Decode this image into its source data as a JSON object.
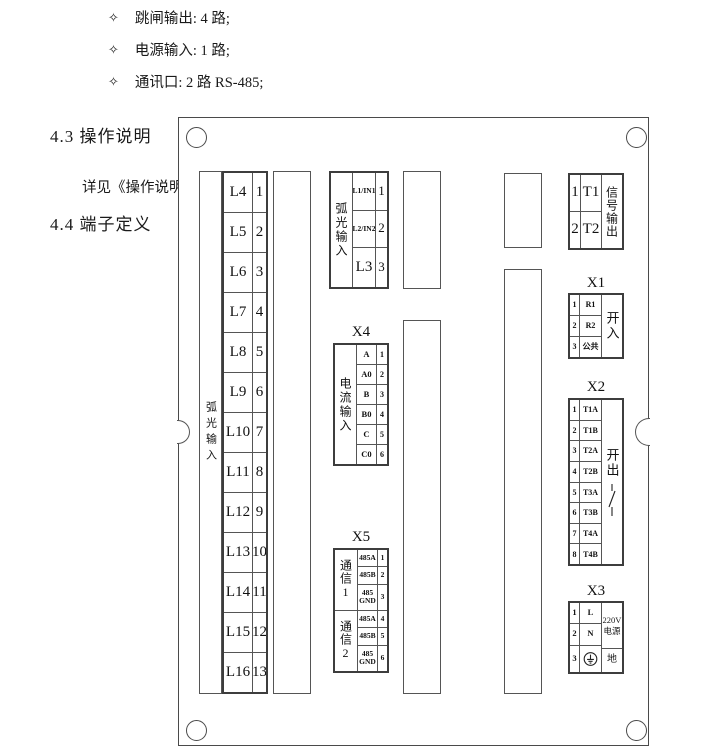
{
  "colors": {
    "line": "#4a4a4a",
    "text": "#1a1a1a"
  },
  "doc": {
    "bullets": [
      {
        "icon": "four-pointed-star",
        "glyph": "✧",
        "text": "跳闸输出: 4 路;"
      },
      {
        "icon": "four-pointed-star",
        "glyph": "✧",
        "text": "电源输入: 1 路;"
      },
      {
        "icon": "four-pointed-star",
        "glyph": "✧",
        "text": "通讯口: 2 路 RS-485;"
      }
    ],
    "heading_43": "4.3 操作说明",
    "see_note": "详见《操作说明书》",
    "heading_44": "4.4 端子定义"
  },
  "board": {
    "left_strip_label": "弧光输入",
    "l_column": {
      "rows": [
        [
          "L4",
          "1"
        ],
        [
          "L5",
          "2"
        ],
        [
          "L6",
          "3"
        ],
        [
          "L7",
          "4"
        ],
        [
          "L8",
          "5"
        ],
        [
          "L9",
          "6"
        ],
        [
          "L10",
          "7"
        ],
        [
          "L11",
          "8"
        ],
        [
          "L12",
          "9"
        ],
        [
          "L13",
          "10"
        ],
        [
          "L14",
          "11"
        ],
        [
          "L15",
          "12"
        ],
        [
          "L16",
          "13"
        ]
      ]
    },
    "arc_block": {
      "label": "弧光输入",
      "rows": [
        [
          "L1/IN1",
          "1"
        ],
        [
          "L2/IN2",
          "2"
        ],
        [
          "L3",
          "3"
        ]
      ]
    },
    "x4": {
      "title": "X4",
      "label": "电流输入",
      "rows": [
        [
          "A",
          "1"
        ],
        [
          "A0",
          "2"
        ],
        [
          "B",
          "3"
        ],
        [
          "B0",
          "4"
        ],
        [
          "C",
          "5"
        ],
        [
          "C0",
          "6"
        ]
      ]
    },
    "x5": {
      "title": "X5",
      "group_labels": [
        "通信1",
        "通信2"
      ],
      "rows": [
        [
          "485A",
          "1"
        ],
        [
          "485B",
          "2"
        ],
        [
          "485\nGND",
          "3"
        ],
        [
          "485A",
          "4"
        ],
        [
          "485B",
          "5"
        ],
        [
          "485\nGND",
          "6"
        ]
      ]
    },
    "signal_block": {
      "label": "信号输出",
      "rows": [
        [
          "1",
          "T1"
        ],
        [
          "2",
          "T2"
        ]
      ]
    },
    "x1": {
      "title": "X1",
      "label": "开入",
      "rows": [
        [
          "1",
          "R1"
        ],
        [
          "2",
          "R2"
        ],
        [
          "3",
          "公共"
        ]
      ]
    },
    "x2": {
      "title": "X2",
      "label": "开出",
      "icon": "switch-contact-icon",
      "rows": [
        [
          "1",
          "T1A"
        ],
        [
          "2",
          "T1B"
        ],
        [
          "3",
          "T2A"
        ],
        [
          "4",
          "T2B"
        ],
        [
          "5",
          "T3A"
        ],
        [
          "6",
          "T3B"
        ],
        [
          "7",
          "T4A"
        ],
        [
          "8",
          "T4B"
        ]
      ]
    },
    "x3": {
      "title": "X3",
      "side_top": "220V\n电源",
      "side_bottom": "地",
      "earth_icon": "earth-ground-icon",
      "rows": [
        [
          "1",
          "L"
        ],
        [
          "2",
          "N"
        ],
        [
          "3",
          "@earth-ground-icon"
        ]
      ]
    }
  }
}
